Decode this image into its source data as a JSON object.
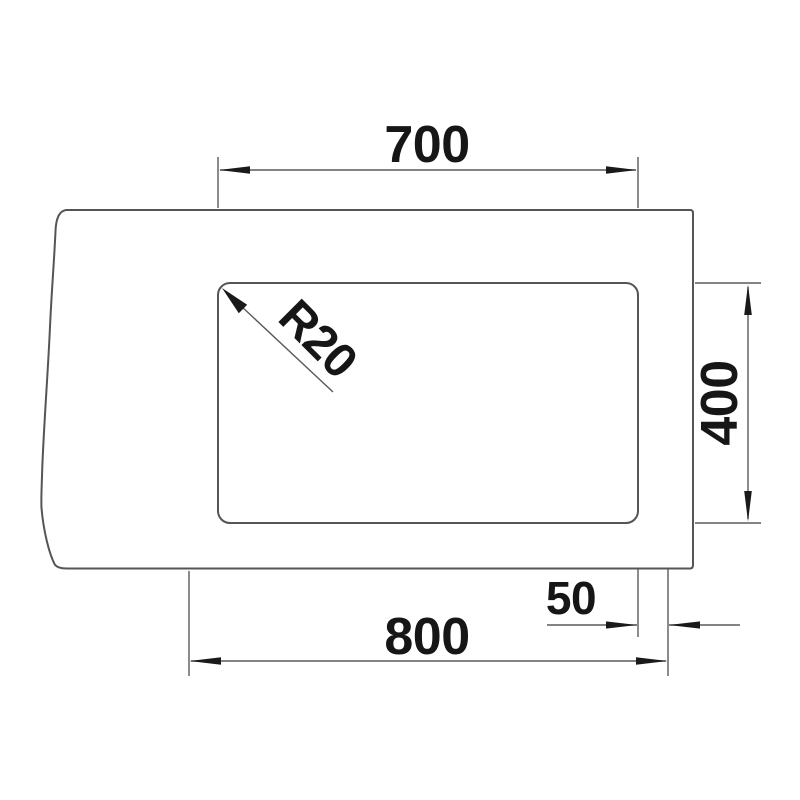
{
  "drawing": {
    "labels": {
      "inner_width": "700",
      "inner_height": "400",
      "outer_width": "800",
      "edge_offset": "50",
      "corner_radius": "R20"
    },
    "colors": {
      "background": "#ffffff",
      "outline": "#555555",
      "dimension_line": "#5a5a5a",
      "ink": "#161616"
    }
  }
}
